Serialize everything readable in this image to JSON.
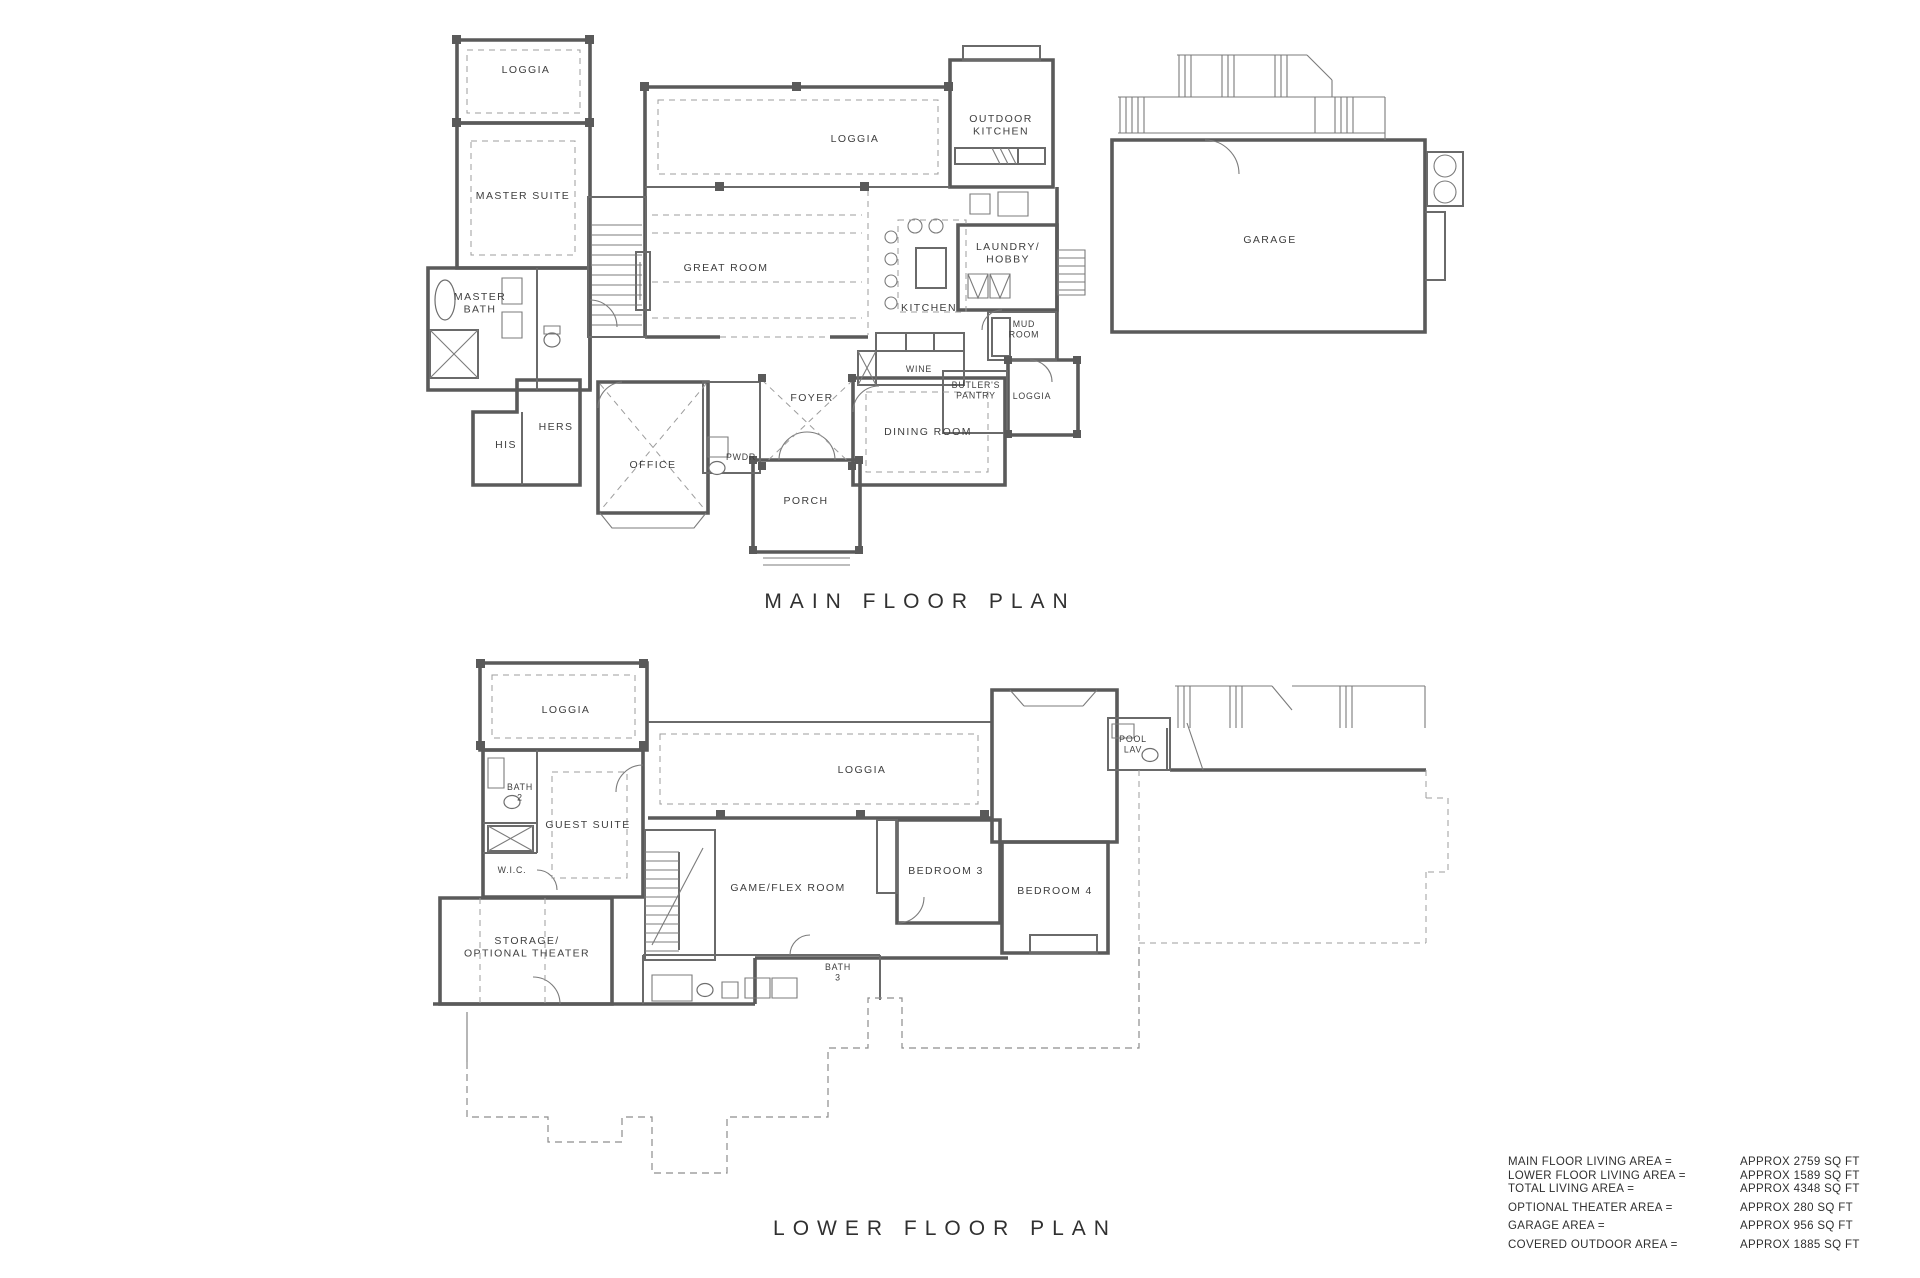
{
  "sheet": {
    "background": "#ffffff",
    "ink": "#3e3e3e",
    "wall_color": "#5a5a5a",
    "dash_color": "#9c9c9c"
  },
  "plans": {
    "main": {
      "title": "MAIN FLOOR PLAN",
      "rooms": {
        "loggia_top_left": "LOGGIA",
        "master_suite": "MASTER SUITE",
        "master_bath": "MASTER\nBATH",
        "his": "HIS",
        "hers": "HERS",
        "office": "OFFICE",
        "pwdr": "PWDR",
        "foyer": "FOYER",
        "porch": "PORCH",
        "dining_room": "DINING ROOM",
        "wine": "WINE",
        "butlers_pantry": "BUTLER'S\nPANTRY",
        "loggia_side": "LOGGIA",
        "mud_room": "MUD\nROOM",
        "laundry_hobby": "LAUNDRY/\nHOBBY",
        "kitchen": "KITCHEN",
        "great_room": "GREAT ROOM",
        "loggia_rear": "LOGGIA",
        "outdoor_kitchen": "OUTDOOR\nKITCHEN",
        "garage": "GARAGE"
      }
    },
    "lower": {
      "title": "LOWER FLOOR PLAN",
      "rooms": {
        "loggia_top_left": "LOGGIA",
        "bath_2": "BATH\n2",
        "guest_suite": "GUEST SUITE",
        "wic": "W.I.C.",
        "storage_theater": "STORAGE/\nOPTIONAL THEATER",
        "game_flex_room": "GAME/FLEX ROOM",
        "bath_3": "BATH\n3",
        "bedroom_3": "BEDROOM 3",
        "bedroom_4": "BEDROOM 4",
        "loggia_center": "LOGGIA",
        "pool_lav": "POOL\nLAV"
      }
    }
  },
  "area_summary": {
    "rows": [
      {
        "label": "MAIN FLOOR LIVING AREA =",
        "value": "APPROX 2759 SQ FT"
      },
      {
        "label": "LOWER FLOOR LIVING AREA =",
        "value": "APPROX 1589 SQ FT"
      },
      {
        "label": "TOTAL LIVING AREA =",
        "value": "APPROX 4348 SQ FT"
      },
      {
        "label": "OPTIONAL THEATER AREA =",
        "value": "APPROX 280 SQ FT"
      },
      {
        "label": "GARAGE AREA =",
        "value": "APPROX 956 SQ FT"
      },
      {
        "label": "COVERED OUTDOOR AREA =",
        "value": "APPROX 1885 SQ FT"
      }
    ]
  }
}
